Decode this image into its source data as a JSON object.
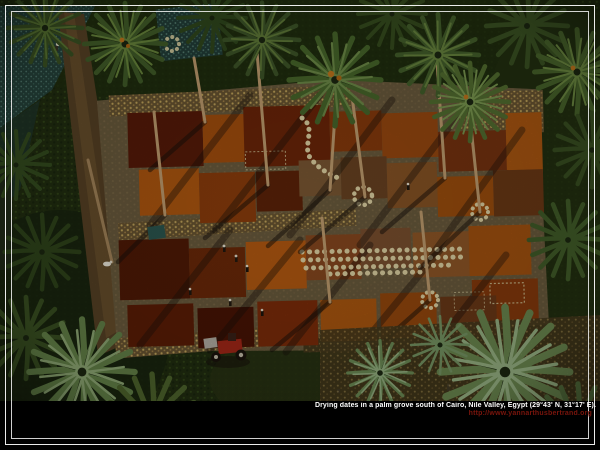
{
  "caption": {
    "line1": "Drying dates in a palm grove south of Cairo, Nile Valley, Egypt (29°43' N, 31°17' E).",
    "line2": "http://www.yannarthusbertrand.org"
  },
  "palette": {
    "frame_white": "#f5f5f5",
    "bottom_band": "#000000",
    "caption_text": "#ffffff",
    "caption_url": "#7a150c",
    "foliage_dark": "#1e2a12",
    "palm_green": "#5c7a34",
    "palm_pale": "#9ab58c",
    "teal_field": "#2c4a44",
    "yard_ground": "#7a684a",
    "date_orange": "#b45810",
    "date_maroon": "#4e1605",
    "straw": "#c9ab5e",
    "sack_cream": "#e6d9a8",
    "tractor_red": "#a82818"
  }
}
